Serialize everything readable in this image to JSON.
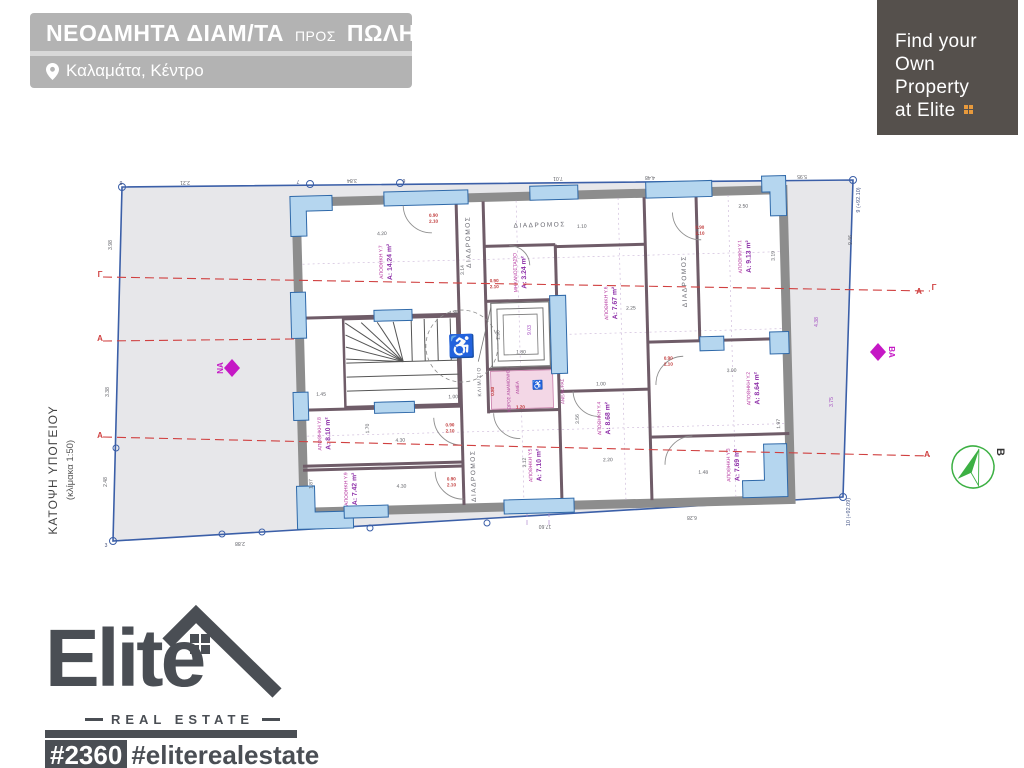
{
  "header": {
    "title_part1": "ΝΕΟΔΜΗΤΑ ΔΙΑΜ/ΤΑ",
    "title_part2": "ΠΡΟΣ",
    "title_part3": "ΠΩΛΗΣΗ",
    "location": "Καλαμάτα, Κέντρο"
  },
  "promo": {
    "line1": "Find your",
    "line2": "Own",
    "line3": "Property",
    "line4": "at Elite"
  },
  "logo": {
    "brand": "Elite",
    "tagline": "REAL ESTATE",
    "listing_id": "#2360",
    "hashtag": "#eliterealestate"
  },
  "plan": {
    "caption": "ΚΑΤΟΨΗ ΥΠΟΓΕΙΟΥ",
    "caption_scale": "(κλίμακα 1:50)",
    "orientation_left": "ΝΑ",
    "orientation_right": "ΒΑ",
    "north_label": "Β",
    "icons": {
      "wheelchair": "♿"
    },
    "rooms": [
      {
        "id": "y7",
        "name": "ΑΠΟΘΗΚΗ Υ.7",
        "area": "Α: 14.24 m²",
        "x": 388,
        "y": 258
      },
      {
        "id": "mhx",
        "name": "ΜΗΧΑΝΟΣΤΑΣΙΟ",
        "area": "Α: 3.24 m²",
        "x": 522,
        "y": 272
      },
      {
        "id": "y6",
        "name": "ΑΠΟΘΗΚΗ Υ.6",
        "area": "Α: 7.67 m²",
        "x": 612,
        "y": 305
      },
      {
        "id": "y1",
        "name": "ΑΠΟΘΗΚΗ Υ.1",
        "area": "Α: 9.13 m²",
        "x": 747,
        "y": 262
      },
      {
        "id": "y2",
        "name": "ΑΠΟΘΗΚΗ Υ.2",
        "area": "Α: 8.64 m²",
        "x": 752,
        "y": 394
      },
      {
        "id": "y3",
        "name": "ΑΠΟΘΗΚΗ Υ.3",
        "area": "Α: 7.69 m²",
        "x": 730,
        "y": 470
      },
      {
        "id": "y4",
        "name": "ΑΠΟΘΗΚΗ Υ.4",
        "area": "Α: 8.68 m²",
        "x": 602,
        "y": 420
      },
      {
        "id": "y5",
        "name": "ΑΠΟΘΗΚΗ Υ.5",
        "area": "Α: 7.10 m²",
        "x": 532,
        "y": 465
      },
      {
        "id": "y8",
        "name": "ΑΠΟΘΗΚΗ Υ.8",
        "area": "Α: 8.10 m²",
        "x": 322,
        "y": 428
      },
      {
        "id": "y9",
        "name": "ΑΠΟΘΗΚΗ Υ.9",
        "area": "Α: 7.42 m²",
        "x": 347,
        "y": 484
      }
    ],
    "free_texts": [
      {
        "t": "2.21",
        "x": 185,
        "y": 181,
        "r": 180,
        "cls": "dg"
      },
      {
        "t": "3.84",
        "x": 352,
        "y": 179,
        "r": 180,
        "cls": "dg"
      },
      {
        "t": "7.01",
        "x": 558,
        "y": 177,
        "r": 180,
        "cls": "dg"
      },
      {
        "t": "4.48",
        "x": 650,
        "y": 176,
        "r": 180,
        "cls": "dg"
      },
      {
        "t": "5.95",
        "x": 802,
        "y": 175,
        "r": 180,
        "cls": "dg"
      },
      {
        "t": "8",
        "x": 121,
        "y": 181,
        "r": 180,
        "cls": "vertex"
      },
      {
        "t": "7",
        "x": 298,
        "y": 180,
        "r": 180,
        "cls": "vertex"
      },
      {
        "t": "6",
        "x": 404,
        "y": 179,
        "r": 180,
        "cls": "vertex"
      },
      {
        "t": "3.98",
        "x": 112,
        "y": 245,
        "r": -90,
        "cls": "dg"
      },
      {
        "t": "3.38",
        "x": 109,
        "y": 392,
        "r": -90,
        "cls": "dg"
      },
      {
        "t": "2.48",
        "x": 107,
        "y": 482,
        "r": -90,
        "cls": "dg"
      },
      {
        "t": "2.88",
        "x": 240,
        "y": 542,
        "r": 180,
        "cls": "dg"
      },
      {
        "t": "17.60",
        "x": 545,
        "y": 525,
        "r": 180,
        "cls": "dg"
      },
      {
        "t": "6.28",
        "x": 692,
        "y": 516,
        "r": 180,
        "cls": "dg"
      },
      {
        "t": "9.46",
        "x": 852,
        "y": 240,
        "r": -90,
        "cls": "dg"
      },
      {
        "t": "4.38",
        "x": 818,
        "y": 322,
        "r": -90,
        "cls": "dp"
      },
      {
        "t": "3.75",
        "x": 833,
        "y": 402,
        "r": -90,
        "cls": "dp"
      },
      {
        "t": "9.03",
        "x": 531,
        "y": 330,
        "r": -90,
        "cls": "dp"
      },
      {
        "t": "3",
        "x": 106,
        "y": 547,
        "cls": "vertex"
      },
      {
        "t": "9 (+92.10)",
        "x": 860,
        "y": 200,
        "r": -90,
        "cls": "corner-label"
      },
      {
        "t": "10 (+92.09)",
        "x": 850,
        "y": 512,
        "r": -90,
        "cls": "corner-label"
      },
      {
        "t": "Γ",
        "x": 100,
        "y": 277,
        "cls": "red-marker"
      },
      {
        "t": "Α",
        "x": 100,
        "y": 341,
        "cls": "red-marker"
      },
      {
        "t": "Α",
        "x": 100,
        "y": 438,
        "cls": "red-marker"
      },
      {
        "t": "Γ",
        "x": 934,
        "y": 290,
        "cls": "red-marker"
      },
      {
        "t": "Α",
        "x": 919,
        "y": 294,
        "cls": "red-marker"
      },
      {
        "t": "Α",
        "x": 927,
        "y": 457,
        "cls": "red-marker"
      }
    ],
    "building_texts": [
      {
        "t": "ΔΙΑΔΡΟΜΟΣ",
        "x": 543,
        "y": 227,
        "cls": "corr"
      },
      {
        "t": "ΔΙΑΔΡΟΜΟΣ",
        "x": 473,
        "y": 240,
        "r": -90,
        "cls": "corr"
      },
      {
        "t": "ΔΙΑΔΡΟΜΟΣ",
        "x": 688,
        "y": 285,
        "r": -90,
        "cls": "corr"
      },
      {
        "t": "ΔΙΑΔΡΟΜΟΣ",
        "x": 472,
        "y": 474,
        "r": -90,
        "cls": "corr"
      },
      {
        "t": "ΚΛΙΜ/ΣΙΟ",
        "x": 480,
        "y": 380,
        "r": -90,
        "cls": "corr2"
      },
      {
        "t": "ΑΝΕΛΚ/ΡΑΣ",
        "x": 563,
        "y": 392,
        "r": -90,
        "cls": "pp"
      },
      {
        "t": "ΧΩΡΟΣ ΑΝΑΜΟΝΗΣ",
        "x": 509,
        "y": 390,
        "r": -90,
        "cls": "pp"
      },
      {
        "t": "ΑΜΕΑ",
        "x": 518,
        "y": 387,
        "r": -90,
        "cls": "pp"
      },
      {
        "t": "0.90",
        "x": 437,
        "y": 214,
        "cls": "dr"
      },
      {
        "t": "2.10",
        "x": 437,
        "y": 220,
        "cls": "dr"
      },
      {
        "t": "0.90",
        "x": 496,
        "y": 281,
        "cls": "dr"
      },
      {
        "t": "2.10",
        "x": 496,
        "y": 287,
        "cls": "dr"
      },
      {
        "t": "0.90",
        "x": 703,
        "y": 233,
        "cls": "dr"
      },
      {
        "t": "2.10",
        "x": 703,
        "y": 239,
        "cls": "dr"
      },
      {
        "t": "0.90",
        "x": 668,
        "y": 363,
        "cls": "dr"
      },
      {
        "t": "2.10",
        "x": 668,
        "y": 369,
        "cls": "dr"
      },
      {
        "t": "0.90",
        "x": 448,
        "y": 424,
        "cls": "dr"
      },
      {
        "t": "2.10",
        "x": 448,
        "y": 430,
        "cls": "dr"
      },
      {
        "t": "0.90",
        "x": 448,
        "y": 478,
        "cls": "dr"
      },
      {
        "t": "2.10",
        "x": 448,
        "y": 484,
        "cls": "dr"
      },
      {
        "t": "4.20",
        "x": 385,
        "y": 231,
        "cls": "dg"
      },
      {
        "t": "1.10",
        "x": 585,
        "y": 229,
        "cls": "dg"
      },
      {
        "t": "2.50",
        "x": 747,
        "y": 213,
        "cls": "dg"
      },
      {
        "t": "3.14",
        "x": 466,
        "y": 268,
        "r": -90,
        "cls": "dg"
      },
      {
        "t": "3.19",
        "x": 777,
        "y": 262,
        "r": -90,
        "cls": "dg"
      },
      {
        "t": "2.25",
        "x": 632,
        "y": 312,
        "cls": "dg"
      },
      {
        "t": "1.00",
        "x": 600,
        "y": 387,
        "cls": "dg"
      },
      {
        "t": "3.00",
        "x": 731,
        "y": 377,
        "cls": "dg"
      },
      {
        "t": "1.80",
        "x": 455,
        "y": 312,
        "cls": "dg"
      },
      {
        "t": "1.00",
        "x": 452,
        "y": 396,
        "cls": "dg"
      },
      {
        "t": "1.45",
        "x": 320,
        "y": 390,
        "cls": "dg"
      },
      {
        "t": "1.70",
        "x": 367,
        "y": 424,
        "r": -90,
        "cls": "dg"
      },
      {
        "t": "4.30",
        "x": 398,
        "y": 438,
        "cls": "dg"
      },
      {
        "t": "4.30",
        "x": 398,
        "y": 484,
        "cls": "dg"
      },
      {
        "t": "1.87",
        "x": 309,
        "y": 478,
        "r": -90,
        "cls": "dg"
      },
      {
        "t": "3.12",
        "x": 523,
        "y": 462,
        "r": -90,
        "cls": "dg"
      },
      {
        "t": "3.56",
        "x": 577,
        "y": 420,
        "r": -90,
        "cls": "dg"
      },
      {
        "t": "2.20",
        "x": 605,
        "y": 463,
        "cls": "dg"
      },
      {
        "t": "1.97",
        "x": 778,
        "y": 430,
        "r": -90,
        "cls": "dg"
      },
      {
        "t": "1.48",
        "x": 700,
        "y": 478,
        "cls": "dg"
      },
      {
        "t": "1.80",
        "x": 521,
        "y": 353,
        "cls": "dg"
      },
      {
        "t": "1.90",
        "x": 500,
        "y": 334,
        "r": -90,
        "cls": "dg"
      },
      {
        "t": "1.20",
        "x": 519,
        "y": 408,
        "cls": "dr"
      },
      {
        "t": "0.80",
        "x": 493,
        "y": 390,
        "r": -90,
        "cls": "dr"
      }
    ]
  },
  "colors": {
    "banner_gray": "#b3b3b3",
    "promo_bg": "#55504c",
    "accent_orange": "#e89a3c",
    "logo_dark": "#4a4e54",
    "plot_blue": "#3b5fa8",
    "plot_fill": "#e7e7ea",
    "wall_gray": "#8d8d8d",
    "window_blue": "#b5d6ef",
    "room_magenta": "#b5369f",
    "dim_red": "#c03a3a",
    "section_red": "#d04040",
    "compass_green": "#3cb043",
    "diamond_magenta": "#c518c5"
  }
}
